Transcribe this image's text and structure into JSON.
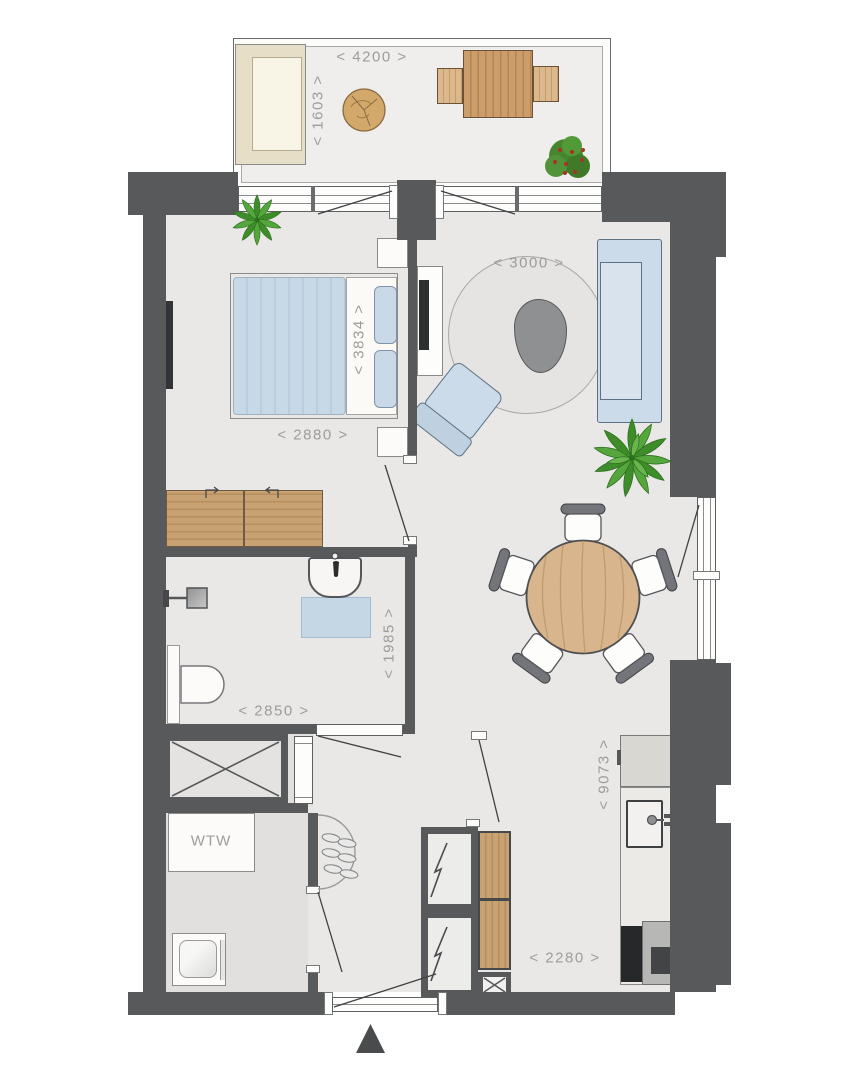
{
  "plan": {
    "title": "apartment-floor-plan",
    "labels": {
      "terrace_width": "< 4200 >",
      "terrace_depth": "< 1603 >",
      "bedroom_length": "< 3834 >",
      "bedroom_width": "< 2880 >",
      "living_rug_diameter": "< 3000 >",
      "bathroom_length": "< 1985 >",
      "bathroom_width": "< 2850 >",
      "apartment_depth": "< 9073 >",
      "kitchen_width": "< 2280 >",
      "ventilation_unit": "WTW"
    },
    "colors": {
      "wall": "#58595b",
      "floor": "#e9e8e6",
      "terrace_floor": "#efeeec",
      "storage_floor": "#e1e0de",
      "dimension_text": "#9c9c9a",
      "furniture_blue": "#ccdbe9",
      "furniture_wood": "#c9a273",
      "rug": "#e5e4e2",
      "coffee_table_gray": "#8f9092",
      "plant_green": "#3e8c2a",
      "entrance_marker": "#4a4b4d"
    },
    "rooms": [
      "terrace",
      "bedroom",
      "living-room",
      "dining-area",
      "bathroom",
      "kitchen",
      "hall",
      "storage-shaft",
      "utility-room"
    ],
    "furniture_and_fixtures": [
      "outdoor-lounge-sofa",
      "trunk-coffee-table",
      "outdoor-dining-table",
      "outdoor-benches",
      "potted-plants",
      "double-bed",
      "pillows",
      "nightstands",
      "wardrobe",
      "wall-tv",
      "tv-cabinet",
      "sofa",
      "armchair",
      "round-rug",
      "organic-coffee-table",
      "round-dining-table",
      "dining-chairs",
      "kitchen-cabinet",
      "kitchen-counter",
      "kitchen-sink",
      "cooktop",
      "bathroom-sink",
      "bath-mat",
      "shower",
      "toilet",
      "wtw-ventilation-unit",
      "washing-machine",
      "shaft-x-box",
      "electrical-shafts",
      "tall-wood-cabinet",
      "coat-rack-with-shoes",
      "entrance-door",
      "entrance-marker-triangle"
    ]
  }
}
